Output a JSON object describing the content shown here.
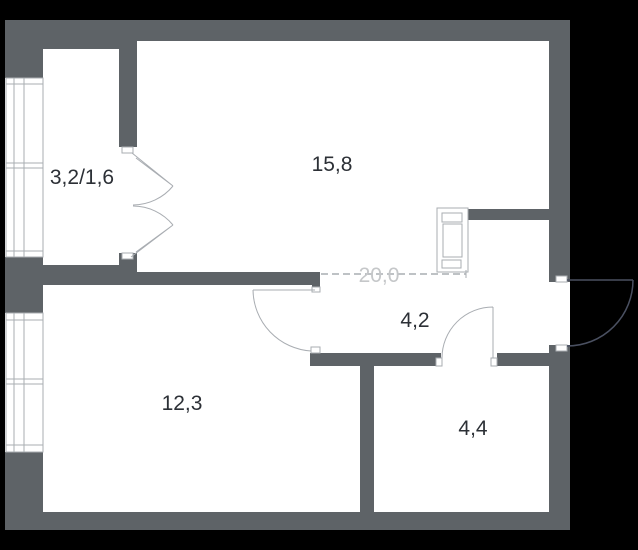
{
  "plan": {
    "room_labels": {
      "balcony": "3,2/1,6",
      "living": "15,8",
      "total": "20,0",
      "hall": "4,2",
      "bedroom": "12,3",
      "bathroom": "4,4"
    },
    "colors": {
      "background": "#000000",
      "floor": "#ffffff",
      "wall": "#5e6367",
      "line": "#a9adb2",
      "entrance_door": "#4a5061",
      "label_text": "#2c3036",
      "total_text": "#c5c7c9"
    }
  }
}
